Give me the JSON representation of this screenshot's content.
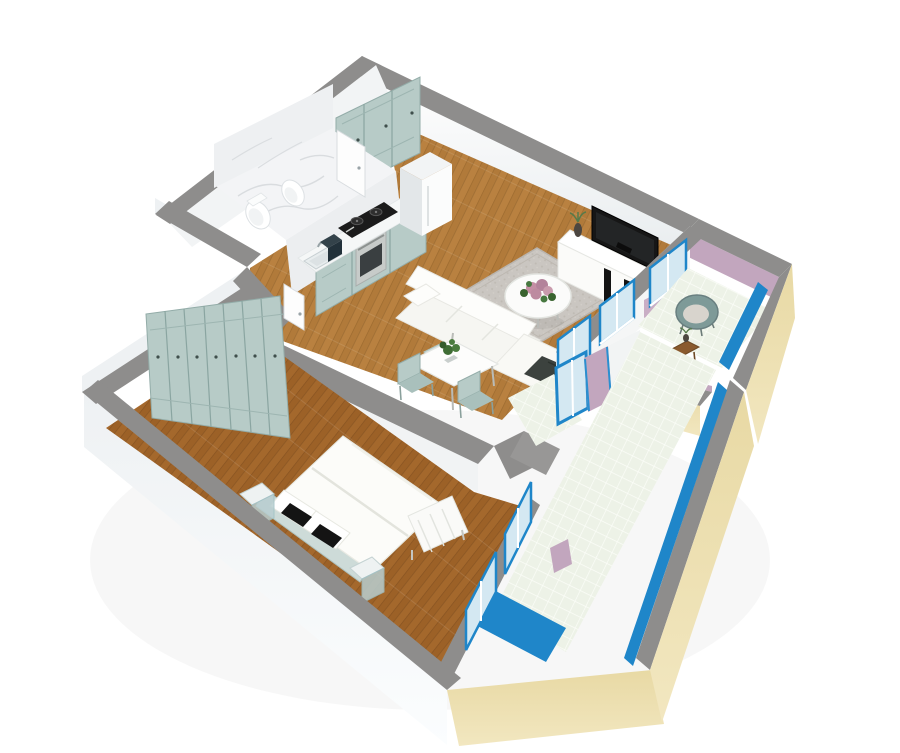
{
  "scene": {
    "type": "3d-floor-plan-render",
    "style": "isometric dollhouse cutaway of a one-bedroom apartment, viewed from above at an angle",
    "background": "#ffffff",
    "palette": {
      "wall_top_gray": "#8e8d8c",
      "wall_interior_white": "#f7f8f8",
      "wall_exterior_white": "#f4f6f7",
      "wall_exterior_beige": "#ecdfad",
      "accent_wall_pink": "#c2a6be",
      "railing_frame_blue": "#1f86c9",
      "glass_blue": "#d4e8f2",
      "cabinet_mint": "#b7cbc7",
      "wood_floor_light": "#b98140",
      "wood_floor_dark": "#a4682c",
      "marble_white": "#f3f4f6",
      "balcony_tile_green": "#edf2e7",
      "rug_gray": "#cac6c1",
      "tv_black": "#161616",
      "chair_teal_gray": "#7e9a98"
    },
    "rooms": [
      {
        "name": "Bathroom",
        "position": "top-left",
        "floor": "white marble platform",
        "features": [
          "toilet",
          "bidet",
          "marble walls",
          "white door to kitchen side",
          "white entry door in corridor"
        ]
      },
      {
        "name": "Kitchen",
        "position": "top-center",
        "floor": "light oak wood",
        "features": [
          "tall mint-green cabinets on back wall",
          "mint base cabinets with white countertop",
          "sink with faucet",
          "black gas cooktop",
          "stainless-steel oven",
          "dark coffee machine",
          "white refrigerator"
        ]
      },
      {
        "name": "Living / dining room",
        "position": "top-right",
        "floor": "light oak wood",
        "features": [
          "white L-shaped sofa with dark throw",
          "gray area rug",
          "round white coffee table with pink flower centerpiece",
          "white TV unit with black TV and black stripes",
          "vase with plant",
          "white dining table with potted plant",
          "two mint dining chairs",
          "blue-framed windows and door to balcony"
        ]
      },
      {
        "name": "Bedroom",
        "position": "bottom-left",
        "floor": "oak wood",
        "features": [
          "full wall of mint wardrobes with dark handles",
          "white double bed with duvet",
          "white pillows with two black accent cushions",
          "mint headboard",
          "two glass nightstands",
          "white slatted bench",
          "blue-framed glass wall to terrace"
        ]
      },
      {
        "name": "Lounge balcony",
        "position": "right",
        "floor": "pale green tile",
        "walls": "pink interior, beige exterior, gray tops",
        "features": [
          "two round teal-gray lounge chairs with light cushions",
          "small wooden side table",
          "small potted plant",
          "blue glass railing strip"
        ]
      },
      {
        "name": "Long terrace",
        "position": "bottom-right edge",
        "floor": "pale green tile with bright blue glass panels",
        "features": [
          "beige parapet with gray top",
          "blue glass railing",
          "blue-framed doors from hallway and bedroom",
          "pink wall columns"
        ]
      }
    ]
  }
}
